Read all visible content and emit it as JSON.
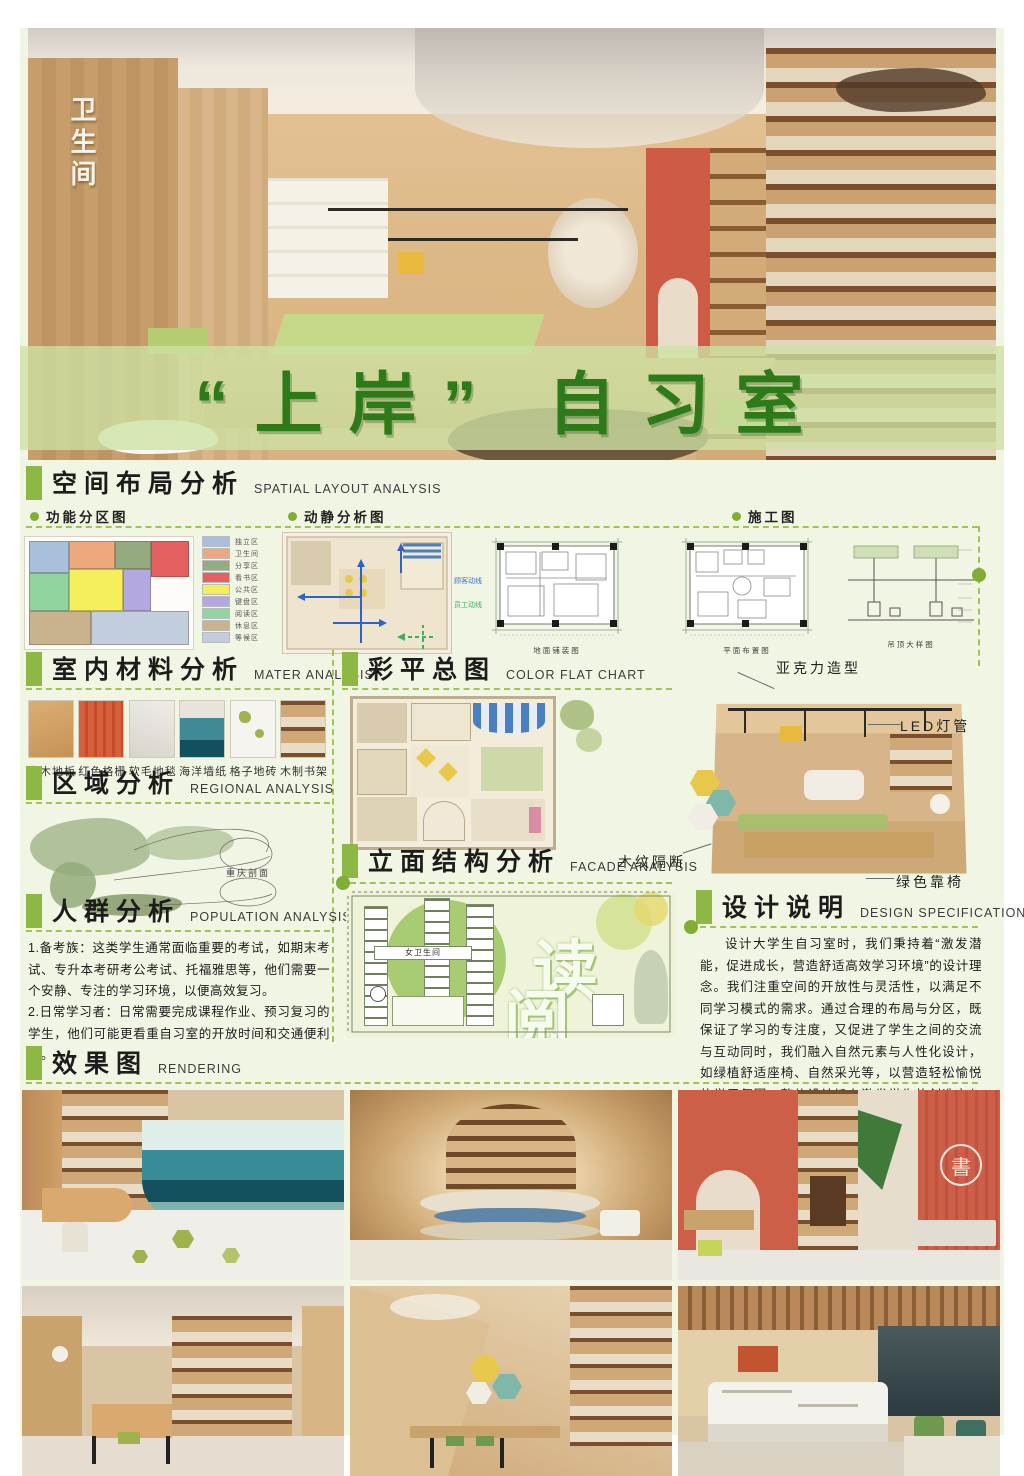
{
  "title": {
    "text": "“上岸” 自习室"
  },
  "hero": {
    "wall_sign": "卫生间"
  },
  "sections": {
    "spatial": {
      "zh": "空间布局分析",
      "en": "SPATIAL LAYOUT ANALYSIS",
      "subs": [
        {
          "label": "功能分区图"
        },
        {
          "label": "动静分析图"
        },
        {
          "label": "施工图"
        }
      ]
    },
    "material": {
      "zh": "室内材料分析",
      "en": "MATER ANALYSIS",
      "items": [
        {
          "label": "实木地板"
        },
        {
          "label": "红色格栅"
        },
        {
          "label": "软毛地毯"
        },
        {
          "label": "海洋墙纸"
        },
        {
          "label": "格子地砖"
        },
        {
          "label": "木制书架"
        }
      ]
    },
    "regional": {
      "zh": "区域分析",
      "en": "REGIONAL ANALYSIS",
      "map_label": "重庆剖面"
    },
    "population": {
      "zh": "人群分析",
      "en": "POPULATION ANALYSIS",
      "text1": "1.备考族：这类学生通常面临重要的考试，如期末考试、专升本考研考公考试、托福雅思等，他们需要一个安静、专注的学习环境，以便高效复习。",
      "text2": "2.日常学习者：日常需要完成课程作业、预习复习的学生，他们可能更看重自习室的开放时间和交通便利性。"
    },
    "rendering": {
      "zh": "效果图",
      "en": "RENDERING"
    },
    "colorflat": {
      "zh": "彩平总图",
      "en": "COLOR FLAT CHART"
    },
    "facade": {
      "zh": "立面结构分析",
      "en": "FACADE ANALYSIS",
      "sign": "女卫生间",
      "char1": "读",
      "char2": "阅"
    },
    "designspec": {
      "zh": "设计说明",
      "en": "DESIGN SPECIFICATION",
      "text": "设计大学生自习室时，我们秉持着“激发潜能，促进成长，营造舒适高效学习环境”的设计理念。我们注重空间的开放性与灵活性，以满足不同学习模式的需求。通过合理的布局与分区，既保证了学习的专注度，又促进了学生之间的交流与互动同时，我们融入自然元素与人性化设计，如绿植舒适座椅、自然采光等，以营造轻松愉悦的学习氛围。整体设计旨在激发学生的创造力与求知欲助力他们在自习室中取得更好的学习成果。"
    }
  },
  "zone_legend": [
    {
      "label": "独立区",
      "color": "#a9c0dc"
    },
    {
      "label": "卫生间",
      "color": "#eda87e"
    },
    {
      "label": "分享区",
      "color": "#93ab7e"
    },
    {
      "label": "看书区",
      "color": "#e45f5f"
    },
    {
      "label": "公共区",
      "color": "#f5ef5d"
    },
    {
      "label": "键盘区",
      "color": "#b3a8e0"
    },
    {
      "label": "阅读区",
      "color": "#92d4a0"
    },
    {
      "label": "休息区",
      "color": "#c9b28e"
    },
    {
      "label": "等候区",
      "color": "#c2cede"
    }
  ],
  "flow_legend": [
    {
      "label": "顾客动线",
      "color": "#3a6fd8"
    },
    {
      "label": "员工动线",
      "color": "#3fae62"
    }
  ],
  "plan_captions": [
    {
      "label": "地面铺装图"
    },
    {
      "label": "平面布置图"
    },
    {
      "label": "吊顶大样图"
    }
  ],
  "annotations": {
    "a1": "亚克力造型",
    "a2": "LED灯管",
    "a3": "木纹隔断",
    "a4": "绿色靠椅"
  },
  "renders": {
    "logo": "書"
  },
  "colors": {
    "accent_green": "#8cb843",
    "dash_green": "#9fc455",
    "title_green": "#2c7a18",
    "band_green": "#cde2a4",
    "bg": "#f1f5e3"
  }
}
